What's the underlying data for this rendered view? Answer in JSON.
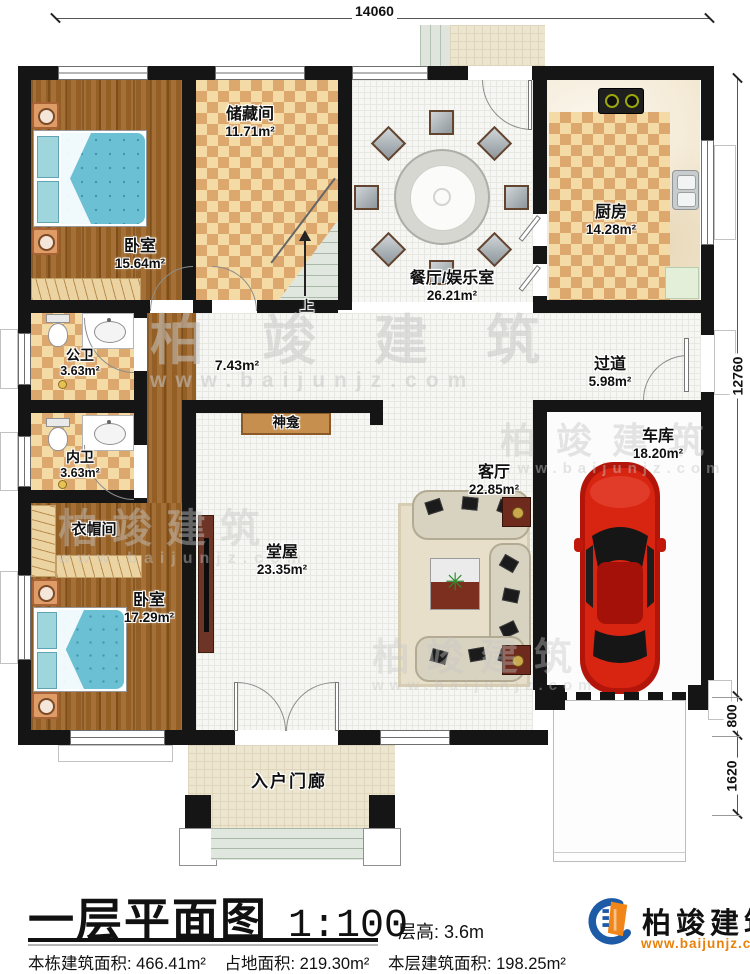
{
  "dimensions": {
    "top_width": "14060",
    "right_height": "12760",
    "right_lower1": "800",
    "right_lower2": "1620"
  },
  "rooms": {
    "bedroom1": {
      "name": "卧室",
      "area": "15.64m²"
    },
    "storage": {
      "name": "储藏间",
      "area": "11.71m²"
    },
    "dining": {
      "name": "餐厅/娱乐室",
      "area": "26.21m²"
    },
    "kitchen": {
      "name": "厨房",
      "area": "14.28m²"
    },
    "public_bath": {
      "name": "公卫",
      "area": "3.63m²"
    },
    "private_bath": {
      "name": "内卫",
      "area": "3.63m²"
    },
    "corridor": {
      "area": "7.43m²"
    },
    "hallway": {
      "name": "过道",
      "area": "5.98m²"
    },
    "shrine": {
      "name": "神龛"
    },
    "living": {
      "name": "客厅",
      "area": "22.85m²"
    },
    "garage": {
      "name": "车库",
      "area": "18.20m²"
    },
    "cloakroom": {
      "name": "衣帽间"
    },
    "bedroom2": {
      "name": "卧室",
      "area": "17.29m²"
    },
    "hall": {
      "name": "堂屋",
      "area": "23.35m²"
    },
    "porch": {
      "name": "入户门廊"
    },
    "stairs": {
      "label": "上"
    }
  },
  "footer": {
    "title": "一层平面图",
    "scale": "1:100",
    "floor_height": "层高: 3.6m",
    "building_area": "本栋建筑面积: 466.41m²",
    "land_area": "占地面积: 219.30m²",
    "floor_area": "本层建筑面积: 198.25m²"
  },
  "brand": {
    "name": "柏竣建筑",
    "website": "www.baijunjz.com"
  },
  "watermark": {
    "name": "柏竣建筑",
    "website": "www.baijunjz.com"
  },
  "colors": {
    "wall": "#151515",
    "wood_floor": "#9c6426",
    "checker_light": "#f4dba6",
    "checker_dark": "#dda86e",
    "bed_blue": "#6cc0d4",
    "car_red": "#d82512",
    "brand_blue": "#1d5ba6",
    "brand_orange": "#f08519",
    "watermark_gray": "#c7c7c7"
  }
}
